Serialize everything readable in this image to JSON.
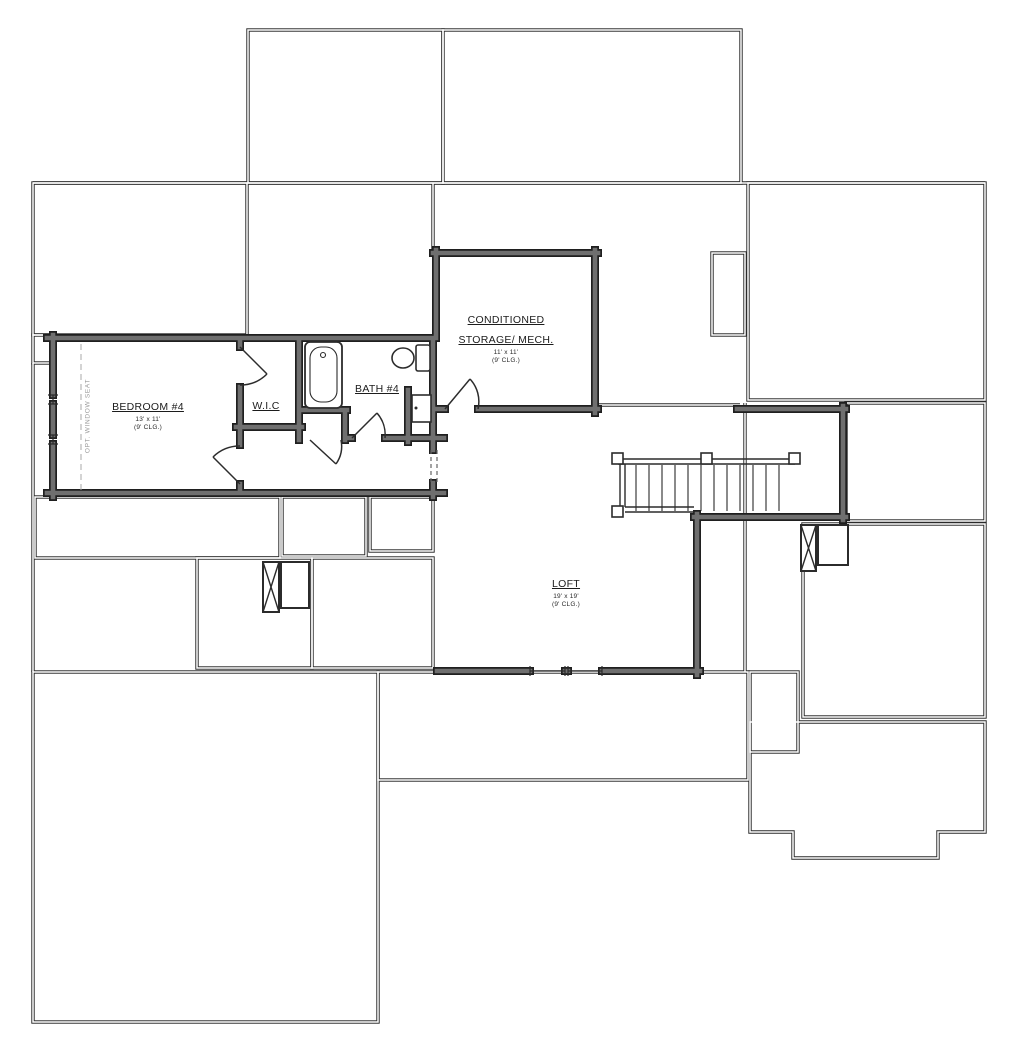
{
  "plan": {
    "type": "floor-plan",
    "rooms": {
      "bedroom4": {
        "name": "BEDROOM #4",
        "size": "13' x 11'",
        "ceiling": "(9' CLG.)"
      },
      "wic": {
        "name": "W.I.C"
      },
      "bath4": {
        "name": "BATH #4"
      },
      "storage_mech": {
        "name_line1": "CONDITIONED",
        "name_line2": "STORAGE/ MECH.",
        "size": "11' x 11'",
        "ceiling": "(9' CLG.)"
      },
      "loft": {
        "name": "LOFT",
        "size": "19' x 19'",
        "ceiling": "(9' CLG.)"
      }
    },
    "annotations": {
      "opt_window_seat": "OPT. WINDOW SEAT"
    },
    "icons": {
      "bathtub": "rounded-rect-tub",
      "toilet": "tank-and-bowl",
      "staircase": "treads-with-rails-and-newel-posts",
      "chase": "x-box",
      "cabinet_door": "rect-with-knob-dot"
    },
    "colors": {
      "background": "#ffffff",
      "wall_edge": "#1f1f1f",
      "wall_fill": "#6f6f6f",
      "thin_line": "#2b2b2b",
      "muted_label": "#9a9a9a"
    }
  }
}
